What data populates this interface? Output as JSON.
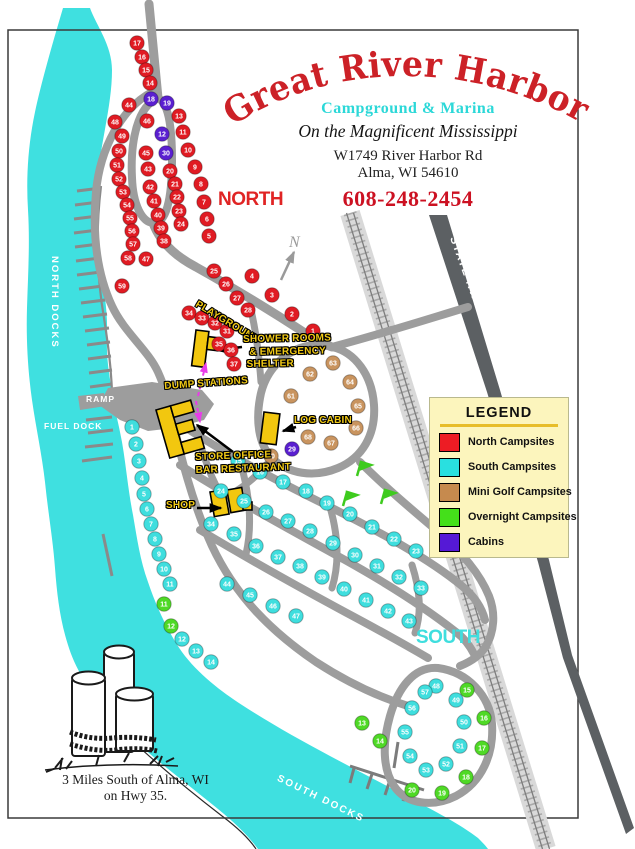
{
  "header": {
    "title": "Great River Harbor",
    "subtitle": "Campground & Marina",
    "tagline": "On the Magnificent Mississippi",
    "address1": "W1749 River Harbor Rd",
    "address2": "Alma, WI 54610",
    "phone": "608-248-2454"
  },
  "map": {
    "section_labels": {
      "north": "NORTH",
      "south": "SOUTH"
    },
    "water_labels": {
      "north_docks": "NORTH DOCKS",
      "ramp": "RAMP",
      "fuel_dock": "FUEL DOCK",
      "south_docks": "SOUTH DOCKS"
    },
    "facility_labels": {
      "playground": "PLAYGROUND",
      "shower": [
        "SHOWER ROOMS",
        "& EMERGENCY",
        "SHELTER"
      ],
      "dump": "DUMP STATIONS",
      "log_cabin": "LOG CABIN",
      "store": [
        "STORE OFFICE",
        "BAR RESTAURANT"
      ],
      "shop": "SHOP"
    },
    "compass": "N",
    "highway": "STATE HWY 35",
    "campsites": [
      {
        "t": "north",
        "x": 137,
        "y": 43,
        "n": "17"
      },
      {
        "t": "north",
        "x": 142,
        "y": 57,
        "n": "16"
      },
      {
        "t": "north",
        "x": 146,
        "y": 70,
        "n": "15"
      },
      {
        "t": "north",
        "x": 150,
        "y": 83,
        "n": "14"
      },
      {
        "t": "north",
        "x": 179,
        "y": 116,
        "n": "13"
      },
      {
        "t": "north",
        "x": 183,
        "y": 132,
        "n": "11"
      },
      {
        "t": "north",
        "x": 188,
        "y": 150,
        "n": "10"
      },
      {
        "t": "north",
        "x": 195,
        "y": 167,
        "n": "9"
      },
      {
        "t": "north",
        "x": 201,
        "y": 184,
        "n": "8"
      },
      {
        "t": "north",
        "x": 204,
        "y": 202,
        "n": "7"
      },
      {
        "t": "north",
        "x": 207,
        "y": 219,
        "n": "6"
      },
      {
        "t": "north",
        "x": 209,
        "y": 236,
        "n": "5"
      },
      {
        "t": "north",
        "x": 170,
        "y": 171,
        "n": "20"
      },
      {
        "t": "north",
        "x": 175,
        "y": 184,
        "n": "21"
      },
      {
        "t": "north",
        "x": 177,
        "y": 197,
        "n": "22"
      },
      {
        "t": "north",
        "x": 179,
        "y": 211,
        "n": "23"
      },
      {
        "t": "north",
        "x": 181,
        "y": 224,
        "n": "24"
      },
      {
        "t": "north",
        "x": 129,
        "y": 105,
        "n": "44"
      },
      {
        "t": "north",
        "x": 147,
        "y": 121,
        "n": "46"
      },
      {
        "t": "north",
        "x": 146,
        "y": 153,
        "n": "45"
      },
      {
        "t": "north",
        "x": 148,
        "y": 169,
        "n": "43"
      },
      {
        "t": "north",
        "x": 150,
        "y": 187,
        "n": "42"
      },
      {
        "t": "north",
        "x": 154,
        "y": 201,
        "n": "41"
      },
      {
        "t": "north",
        "x": 158,
        "y": 215,
        "n": "40"
      },
      {
        "t": "north",
        "x": 161,
        "y": 228,
        "n": "39"
      },
      {
        "t": "north",
        "x": 164,
        "y": 241,
        "n": "38"
      },
      {
        "t": "north",
        "x": 115,
        "y": 122,
        "n": "48"
      },
      {
        "t": "north",
        "x": 122,
        "y": 136,
        "n": "49"
      },
      {
        "t": "north",
        "x": 119,
        "y": 151,
        "n": "50"
      },
      {
        "t": "north",
        "x": 117,
        "y": 165,
        "n": "51"
      },
      {
        "t": "north",
        "x": 119,
        "y": 179,
        "n": "52"
      },
      {
        "t": "north",
        "x": 123,
        "y": 192,
        "n": "53"
      },
      {
        "t": "north",
        "x": 127,
        "y": 205,
        "n": "54"
      },
      {
        "t": "north",
        "x": 130,
        "y": 218,
        "n": "55"
      },
      {
        "t": "north",
        "x": 132,
        "y": 231,
        "n": "56"
      },
      {
        "t": "north",
        "x": 133,
        "y": 244,
        "n": "57"
      },
      {
        "t": "north",
        "x": 128,
        "y": 258,
        "n": "58"
      },
      {
        "t": "north",
        "x": 122,
        "y": 286,
        "n": "59"
      },
      {
        "t": "north",
        "x": 146,
        "y": 259,
        "n": "47"
      },
      {
        "t": "north",
        "x": 214,
        "y": 271,
        "n": "25"
      },
      {
        "t": "north",
        "x": 226,
        "y": 284,
        "n": "26"
      },
      {
        "t": "north",
        "x": 237,
        "y": 298,
        "n": "27"
      },
      {
        "t": "north",
        "x": 248,
        "y": 310,
        "n": "28"
      },
      {
        "t": "north",
        "x": 189,
        "y": 313,
        "n": "34"
      },
      {
        "t": "north",
        "x": 202,
        "y": 318,
        "n": "33"
      },
      {
        "t": "north",
        "x": 215,
        "y": 323,
        "n": "32"
      },
      {
        "t": "north",
        "x": 227,
        "y": 331,
        "n": "31"
      },
      {
        "t": "north",
        "x": 219,
        "y": 344,
        "n": "35"
      },
      {
        "t": "north",
        "x": 231,
        "y": 350,
        "n": "36"
      },
      {
        "t": "north",
        "x": 234,
        "y": 364,
        "n": "37"
      },
      {
        "t": "north",
        "x": 252,
        "y": 276,
        "n": "4"
      },
      {
        "t": "north",
        "x": 272,
        "y": 295,
        "n": "3"
      },
      {
        "t": "north",
        "x": 292,
        "y": 314,
        "n": "2"
      },
      {
        "t": "north",
        "x": 313,
        "y": 331,
        "n": "1"
      },
      {
        "t": "cabin",
        "x": 151,
        "y": 99,
        "n": "18"
      },
      {
        "t": "cabin",
        "x": 167,
        "y": 103,
        "n": "19"
      },
      {
        "t": "cabin",
        "x": 162,
        "y": 134,
        "n": "12"
      },
      {
        "t": "cabin",
        "x": 166,
        "y": 153,
        "n": "30"
      },
      {
        "t": "cabin",
        "x": 292,
        "y": 449,
        "n": "29"
      },
      {
        "t": "minigolf",
        "x": 271,
        "y": 456,
        "n": "60"
      },
      {
        "t": "minigolf",
        "x": 291,
        "y": 396,
        "n": "61"
      },
      {
        "t": "minigolf",
        "x": 310,
        "y": 374,
        "n": "62"
      },
      {
        "t": "minigolf",
        "x": 333,
        "y": 363,
        "n": "63"
      },
      {
        "t": "minigolf",
        "x": 350,
        "y": 382,
        "n": "64"
      },
      {
        "t": "minigolf",
        "x": 358,
        "y": 406,
        "n": "65"
      },
      {
        "t": "minigolf",
        "x": 356,
        "y": 428,
        "n": "66"
      },
      {
        "t": "minigolf",
        "x": 331,
        "y": 443,
        "n": "67"
      },
      {
        "t": "minigolf",
        "x": 308,
        "y": 437,
        "n": "68"
      },
      {
        "t": "overnight",
        "x": 164,
        "y": 604,
        "n": "11"
      },
      {
        "t": "overnight",
        "x": 171,
        "y": 626,
        "n": "12"
      },
      {
        "t": "overnight",
        "x": 362,
        "y": 723,
        "n": "13"
      },
      {
        "t": "overnight",
        "x": 380,
        "y": 741,
        "n": "14"
      },
      {
        "t": "overnight",
        "x": 467,
        "y": 690,
        "n": "15"
      },
      {
        "t": "overnight",
        "x": 484,
        "y": 718,
        "n": "16"
      },
      {
        "t": "overnight",
        "x": 482,
        "y": 748,
        "n": "17"
      },
      {
        "t": "overnight",
        "x": 466,
        "y": 777,
        "n": "18"
      },
      {
        "t": "overnight",
        "x": 442,
        "y": 793,
        "n": "19"
      },
      {
        "t": "overnight",
        "x": 412,
        "y": 790,
        "n": "20"
      },
      {
        "t": "south",
        "x": 132,
        "y": 427,
        "n": "1"
      },
      {
        "t": "south",
        "x": 136,
        "y": 444,
        "n": "2"
      },
      {
        "t": "south",
        "x": 139,
        "y": 461,
        "n": "3"
      },
      {
        "t": "south",
        "x": 142,
        "y": 478,
        "n": "4"
      },
      {
        "t": "south",
        "x": 144,
        "y": 494,
        "n": "5"
      },
      {
        "t": "south",
        "x": 147,
        "y": 509,
        "n": "6"
      },
      {
        "t": "south",
        "x": 151,
        "y": 524,
        "n": "7"
      },
      {
        "t": "south",
        "x": 155,
        "y": 539,
        "n": "8"
      },
      {
        "t": "south",
        "x": 159,
        "y": 554,
        "n": "9"
      },
      {
        "t": "south",
        "x": 164,
        "y": 569,
        "n": "10"
      },
      {
        "t": "south",
        "x": 170,
        "y": 584,
        "n": "11"
      },
      {
        "t": "south",
        "x": 182,
        "y": 639,
        "n": "12"
      },
      {
        "t": "south",
        "x": 196,
        "y": 651,
        "n": "13"
      },
      {
        "t": "south",
        "x": 211,
        "y": 662,
        "n": "14"
      },
      {
        "t": "south",
        "x": 238,
        "y": 461,
        "n": "15"
      },
      {
        "t": "south",
        "x": 260,
        "y": 472,
        "n": "16"
      },
      {
        "t": "south",
        "x": 283,
        "y": 482,
        "n": "17"
      },
      {
        "t": "south",
        "x": 306,
        "y": 491,
        "n": "18"
      },
      {
        "t": "south",
        "x": 327,
        "y": 503,
        "n": "19"
      },
      {
        "t": "south",
        "x": 350,
        "y": 514,
        "n": "20"
      },
      {
        "t": "south",
        "x": 372,
        "y": 527,
        "n": "21"
      },
      {
        "t": "south",
        "x": 394,
        "y": 539,
        "n": "22"
      },
      {
        "t": "south",
        "x": 416,
        "y": 551,
        "n": "23"
      },
      {
        "t": "south",
        "x": 221,
        "y": 491,
        "n": "24"
      },
      {
        "t": "south",
        "x": 244,
        "y": 501,
        "n": "25"
      },
      {
        "t": "south",
        "x": 266,
        "y": 512,
        "n": "26"
      },
      {
        "t": "south",
        "x": 288,
        "y": 521,
        "n": "27"
      },
      {
        "t": "south",
        "x": 310,
        "y": 531,
        "n": "28"
      },
      {
        "t": "south",
        "x": 333,
        "y": 543,
        "n": "29"
      },
      {
        "t": "south",
        "x": 355,
        "y": 555,
        "n": "30"
      },
      {
        "t": "south",
        "x": 377,
        "y": 566,
        "n": "31"
      },
      {
        "t": "south",
        "x": 399,
        "y": 577,
        "n": "32"
      },
      {
        "t": "south",
        "x": 421,
        "y": 588,
        "n": "33"
      },
      {
        "t": "south",
        "x": 211,
        "y": 524,
        "n": "34"
      },
      {
        "t": "south",
        "x": 234,
        "y": 534,
        "n": "35"
      },
      {
        "t": "south",
        "x": 256,
        "y": 546,
        "n": "36"
      },
      {
        "t": "south",
        "x": 278,
        "y": 557,
        "n": "37"
      },
      {
        "t": "south",
        "x": 300,
        "y": 566,
        "n": "38"
      },
      {
        "t": "south",
        "x": 322,
        "y": 577,
        "n": "39"
      },
      {
        "t": "south",
        "x": 344,
        "y": 589,
        "n": "40"
      },
      {
        "t": "south",
        "x": 366,
        "y": 600,
        "n": "41"
      },
      {
        "t": "south",
        "x": 388,
        "y": 611,
        "n": "42"
      },
      {
        "t": "south",
        "x": 409,
        "y": 621,
        "n": "43"
      },
      {
        "t": "south",
        "x": 227,
        "y": 584,
        "n": "44"
      },
      {
        "t": "south",
        "x": 250,
        "y": 595,
        "n": "45"
      },
      {
        "t": "south",
        "x": 273,
        "y": 606,
        "n": "46"
      },
      {
        "t": "south",
        "x": 296,
        "y": 616,
        "n": "47"
      },
      {
        "t": "south",
        "x": 436,
        "y": 686,
        "n": "48"
      },
      {
        "t": "south",
        "x": 456,
        "y": 700,
        "n": "49"
      },
      {
        "t": "south",
        "x": 464,
        "y": 722,
        "n": "50"
      },
      {
        "t": "south",
        "x": 460,
        "y": 746,
        "n": "51"
      },
      {
        "t": "south",
        "x": 446,
        "y": 764,
        "n": "52"
      },
      {
        "t": "south",
        "x": 426,
        "y": 770,
        "n": "53"
      },
      {
        "t": "south",
        "x": 410,
        "y": 756,
        "n": "54"
      },
      {
        "t": "south",
        "x": 405,
        "y": 732,
        "n": "55"
      },
      {
        "t": "south",
        "x": 412,
        "y": 708,
        "n": "56"
      },
      {
        "t": "south",
        "x": 425,
        "y": 692,
        "n": "57"
      }
    ]
  },
  "legend": {
    "title": "LEGEND",
    "items": [
      {
        "label": "North Campsites",
        "color": "#ed1c24"
      },
      {
        "label": "South Campsites",
        "color": "#29e0e0"
      },
      {
        "label": "Mini Golf Campsites",
        "color": "#c68a4e"
      },
      {
        "label": "Overnight Campsites",
        "color": "#44e01a"
      },
      {
        "label": "Cabins",
        "color": "#5519d6"
      }
    ]
  },
  "footer": {
    "line1": "3 Miles South of Alma, WI",
    "line2": "on Hwy 35."
  },
  "colors": {
    "north": "#e01b23",
    "south": "#3fdede",
    "minigolf": "#c9945f",
    "overnight": "#4fd926",
    "cabin": "#5a1fd0",
    "river": "#3fe0e0",
    "road": "#9d9d9d",
    "hwy": "#5c6063",
    "rail_band": "#d9d9d9",
    "rail_tie": "#a9a9a9",
    "rail_line": "#7d7d7d",
    "title_red": "#cc2127",
    "sub_cyan": "#2cd8d8",
    "phone_red": "#cc1122",
    "legend_bg": "#fcf5bd",
    "legend_rule": "#e7bd2a",
    "building": "#f2c70f",
    "label_yellow": "#f2ca15",
    "magenta": "#e83ce8",
    "north_label": "#e02424",
    "south_label": "#3fdede",
    "water_text": "#ffffff"
  }
}
